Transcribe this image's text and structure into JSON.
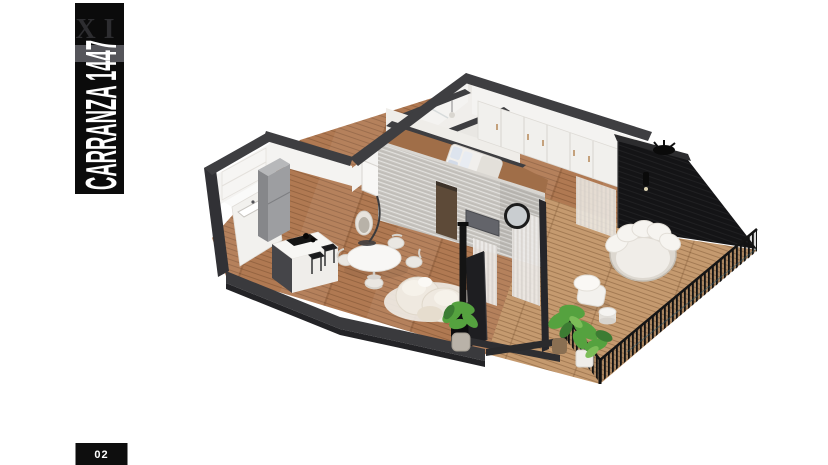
{
  "canvas": {
    "background": "#ffffff"
  },
  "banner": {
    "roman_numeral": "XI",
    "title": "CARRANZA 1447",
    "background": "#0b0b0b",
    "title_color": "#ffffff",
    "numeral_color": "#2d2d30",
    "stripe_color": "#55555a"
  },
  "page_badge": {
    "label": "02",
    "background": "#0e0e0e",
    "text_color": "#ffffff"
  },
  "floorplan": {
    "type": "isometric-3d-floor-plan",
    "rooms": [
      "kitchen",
      "living-dining",
      "bedroom",
      "bathroom",
      "hall",
      "wardrobe",
      "terrace"
    ],
    "furniture": [
      "kitchen-island",
      "bar-stools",
      "fridge",
      "sink-counter",
      "dining-table",
      "dining-chairs",
      "curved-sofa",
      "hanging-chair",
      "wood-stove",
      "tv-panel",
      "round-mirror",
      "bed",
      "closet-doors",
      "round-daybed",
      "armchair",
      "side-table",
      "potted-plants",
      "terrace-railing"
    ],
    "palette": {
      "wall_cap": "#3e3e41",
      "wall_face": "#f4f3f1",
      "brick_wall": "#c7c4bf",
      "wood_floor": "#b07952",
      "deck": "#c59a6f",
      "black_wall": "#141416",
      "railing": "#131313",
      "furniture_white": "#f2f0ec",
      "plant_green": "#55a23f"
    }
  }
}
